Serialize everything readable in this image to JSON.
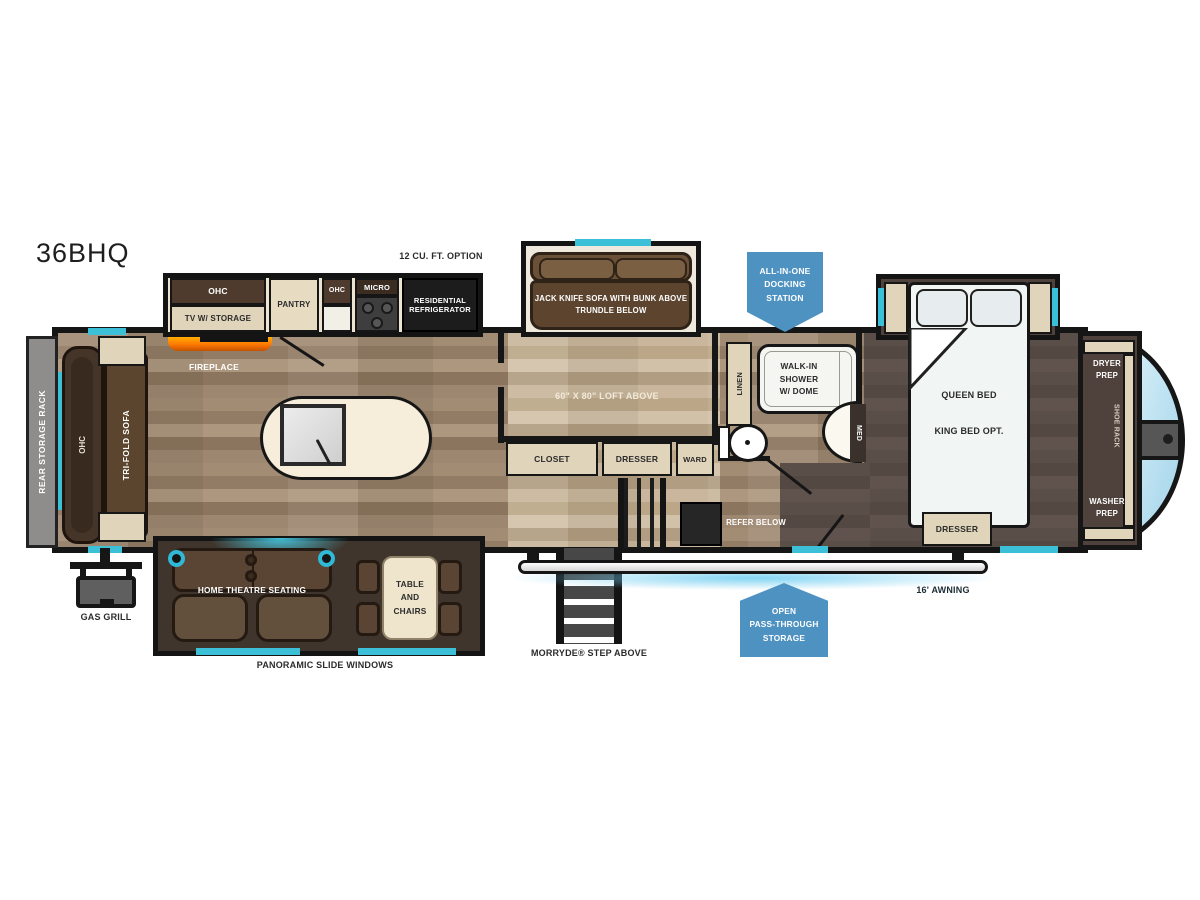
{
  "model": "36BHQ",
  "colors": {
    "teal": "#3cc0d8",
    "badge_blue": "#4e92c2",
    "fireplace_orange": "#ff8a00"
  },
  "exterior": {
    "rear_storage_rack": "REAR STORAGE RACK",
    "gas_grill": "GAS GRILL",
    "docking_station": "ALL-IN-ONE\nDOCKING\nSTATION",
    "pass_through": "OPEN\nPASS-THROUGH\nSTORAGE",
    "awning": "16' AWNING",
    "step": "MORRYDE® STEP ABOVE",
    "panoramic_windows": "PANORAMIC SLIDE WINDOWS"
  },
  "kitchen": {
    "ohc_tv": "OHC",
    "tv_storage": "TV W/ STORAGE",
    "pantry": "PANTRY",
    "ohc_small": "OHC",
    "micro": "MICRO",
    "refrigerator": "RESIDENTIAL\nREFRIGERATOR",
    "refrigerator_option": "12 CU. FT. OPTION",
    "fireplace": "FIREPLACE"
  },
  "living": {
    "sofa_ohc": "OHC",
    "tri_fold_sofa": "TRI-FOLD SOFA",
    "home_theatre": "HOME THEATRE SEATING",
    "table_chairs": "TABLE\nAND\nCHAIRS"
  },
  "bunk_room": {
    "jack_knife_sofa": "JACK KNIFE SOFA WITH BUNK ABOVE\nTRUNDLE BELOW",
    "loft": "60\" X 80\" LOFT ABOVE",
    "closet": "CLOSET",
    "dresser": "DRESSER",
    "ward": "WARD",
    "refer": "REFER BELOW"
  },
  "bathroom": {
    "linen": "LINEN",
    "shower": "WALK-IN\nSHOWER\nW/ DOME",
    "med": "MED"
  },
  "bedroom": {
    "queen_bed": "QUEEN BED",
    "king_option": "KING BED OPT.",
    "dresser": "DRESSER",
    "dryer_prep": "DRYER\nPREP",
    "washer_prep": "WASHER\nPREP",
    "shoe_rack": "SHOE RACK"
  }
}
